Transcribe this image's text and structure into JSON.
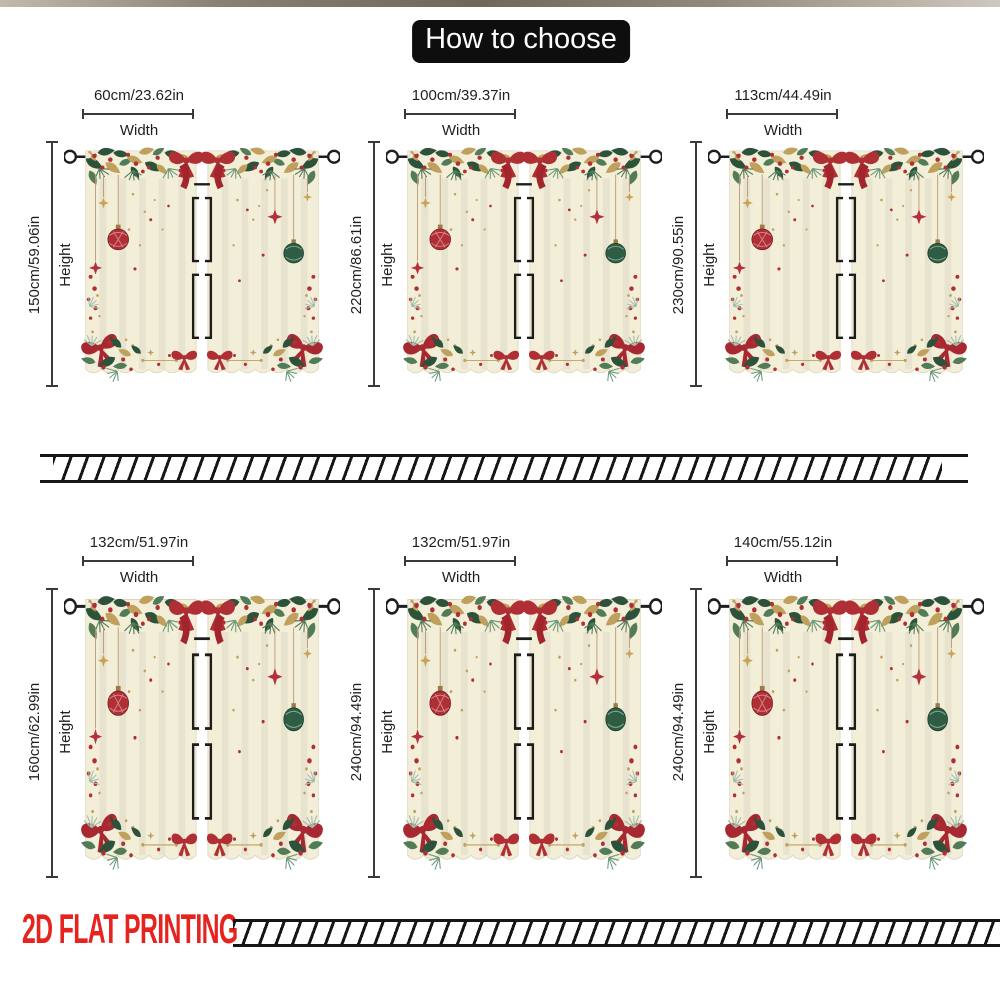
{
  "title": "How to choose",
  "footer": {
    "label": "2D FLAT PRINTING"
  },
  "labels": {
    "width": "Width",
    "height": "Height"
  },
  "colors": {
    "title-bg": "#0e0e0e",
    "title-text": "#ffffff",
    "measure": "#3a3a3a",
    "footer-red": "#e52420",
    "hatch-ink": "#161616",
    "curtain-cream": "#f3eed8",
    "holly-green": "#2c523a",
    "ornament-red": "#b02f35",
    "ornament-green": "#2e5c45",
    "gold": "#bfa05c"
  },
  "cards": [
    {
      "width_label": "60cm/23.62in",
      "height_label": "150cm/59.06in"
    },
    {
      "width_label": "100cm/39.37in",
      "height_label": "220cm/86.61in"
    },
    {
      "width_label": "113cm/44.49in",
      "height_label": "230cm/90.55in"
    },
    {
      "width_label": "132cm/51.97in",
      "height_label": "160cm/62.99in"
    },
    {
      "width_label": "132cm/51.97in",
      "height_label": "240cm/94.49in"
    },
    {
      "width_label": "140cm/55.12in",
      "height_label": "240cm/94.49in"
    }
  ]
}
